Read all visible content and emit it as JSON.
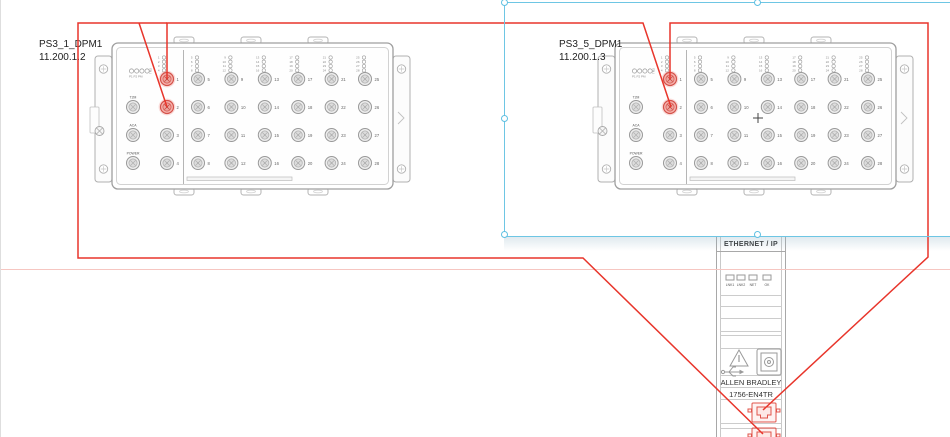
{
  "devices": [
    {
      "name": "PS3_1_DPM1",
      "ip": "11.200.1.2",
      "aux_port_labels": [
        "T2M",
        "ACA",
        "POWER"
      ],
      "status_led_labels": "P1 P2 PM",
      "side_label": "TM2",
      "port_numbers_left": [
        1,
        2,
        3,
        4
      ],
      "port_columns": [
        [
          5,
          6,
          7,
          8
        ],
        [
          9,
          10,
          11,
          12
        ],
        [
          13,
          14,
          15,
          16
        ],
        [
          17,
          18,
          19,
          20
        ],
        [
          21,
          22,
          23,
          24
        ],
        [
          25,
          26,
          27,
          28
        ]
      ],
      "highlighted_ports": [
        1,
        2
      ]
    },
    {
      "name": "PS3_5_DPM1",
      "ip": "11.200.1.3",
      "aux_port_labels": [
        "T2M",
        "ACA",
        "POWER"
      ],
      "status_led_labels": "P1 P2 PM",
      "side_label": "TM2",
      "port_numbers_left": [
        1,
        2,
        3,
        4
      ],
      "port_columns": [
        [
          5,
          6,
          7,
          8
        ],
        [
          9,
          10,
          11,
          12
        ],
        [
          13,
          14,
          15,
          16
        ],
        [
          17,
          18,
          19,
          20
        ],
        [
          21,
          22,
          23,
          24
        ],
        [
          25,
          26,
          27,
          28
        ]
      ],
      "highlighted_ports": [
        1,
        2
      ]
    }
  ],
  "plc_module": {
    "protocol_label": "ETHERNET / IP",
    "led_labels": [
      "LNK1",
      "LNK2",
      "NET",
      "OK"
    ],
    "brand": "ALLEN BRADLEY",
    "model": "1756-EN4TR"
  },
  "connections": [
    {
      "from": "PS3_1_DPM1 port 2",
      "to": "1756-EN4TR port 2"
    },
    {
      "from": "PS3_1_DPM1 port 1",
      "to": "PS3_5_DPM1 port 2"
    },
    {
      "from": "PS3_5_DPM1 port 1",
      "to": "1756-EN4TR port 1"
    }
  ],
  "selection": {
    "center_marker": "+",
    "selected": "PS3_5_DPM1"
  },
  "colors": {
    "wire": "#e8352b",
    "guide_line": "#f6c6c1",
    "selection": "#6ec6e4",
    "device_outline": "#9f9f9f",
    "highlight_port": "#d4524a",
    "highlight_fill": "#f5b3ae"
  }
}
